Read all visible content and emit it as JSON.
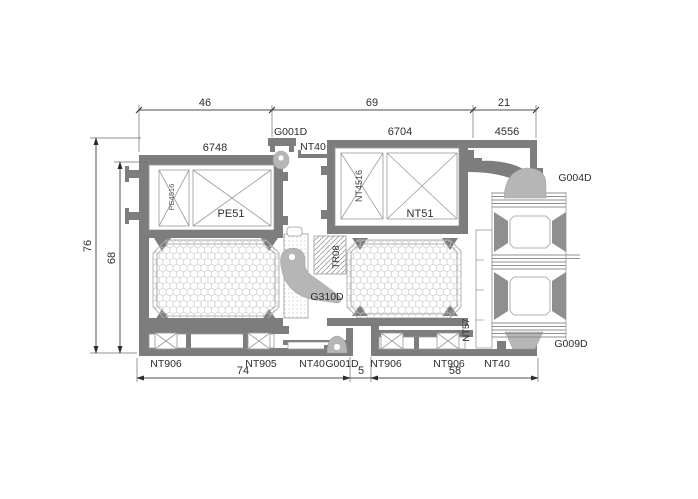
{
  "drawing": {
    "title": "aluminium-profile-cross-section",
    "dimensions": {
      "top": [
        "46",
        "69",
        "21"
      ],
      "left": [
        "76",
        "68"
      ],
      "bottom": [
        "74",
        "5",
        "58"
      ]
    },
    "codes": {
      "frame_top": "6748",
      "sash_top": "6704",
      "extension": "4556",
      "gasket_top": "G001D",
      "adapter_top": "NT40",
      "frame_insert": "PE4516",
      "frame_profile": "PE51",
      "sash_insert": "NT4516",
      "sash_profile": "NT51",
      "thermal_break": "TR08",
      "gasket_mid": "G310D",
      "gasket_panel_top": "G004D",
      "gasket_panel_bottom": "G009D",
      "glazing_bead": "NT57",
      "sill_left": [
        "NT906",
        "NT905",
        "NT40",
        "G001D"
      ],
      "sill_right": [
        "NT906",
        "NT906",
        "NT40"
      ]
    },
    "colors": {
      "profile": "#7d7d7d",
      "gasket": "#b6b6b6",
      "dimension_line": "#4d4d4d",
      "background": "#ffffff"
    }
  }
}
